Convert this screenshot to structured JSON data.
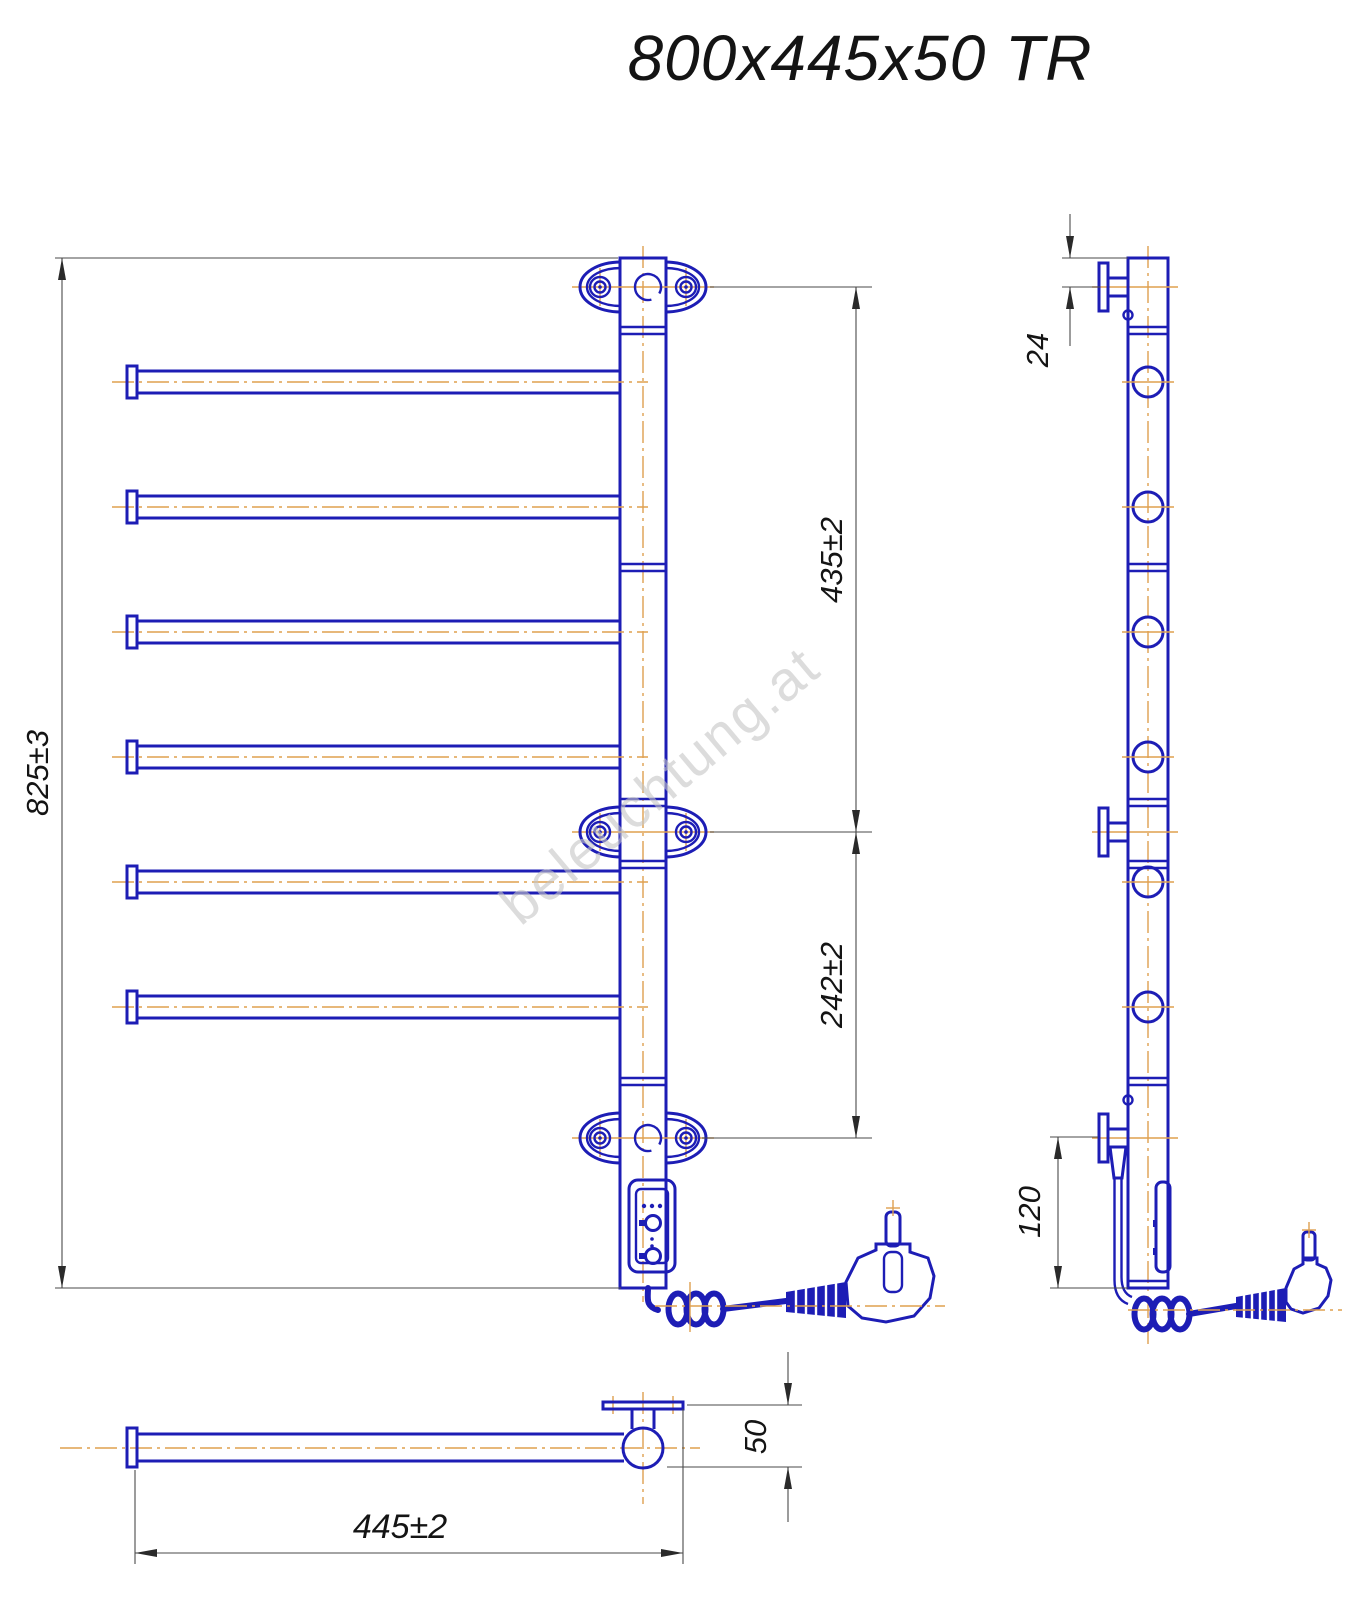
{
  "title": "800x445x50 TR",
  "watermark": "beleuchtung.at",
  "dimensions": {
    "overall_height": "825±3",
    "top_bracket_to_middle_bracket": "435±2",
    "middle_bracket_to_bottom_bracket": "242±2",
    "post_top_to_bracket": "24",
    "bottom_bracket_to_post_end": "120",
    "overall_width": "445±2",
    "rail_depth": "50"
  },
  "colors": {
    "outline": "#1d1db5",
    "centerline": "#dfa04f",
    "dimension_lines": "#4a4a4a",
    "dimension_text": "#141414",
    "watermark": "#c6c6c6",
    "background": "#ffffff"
  },
  "drawing": {
    "rung_count": 6,
    "rung_center_ys": [
      382,
      507,
      632,
      757,
      882,
      1007
    ],
    "bracket_center_ys": [
      287,
      832,
      1138
    ],
    "joint_ys": [
      327,
      564,
      799,
      861,
      1078
    ]
  }
}
